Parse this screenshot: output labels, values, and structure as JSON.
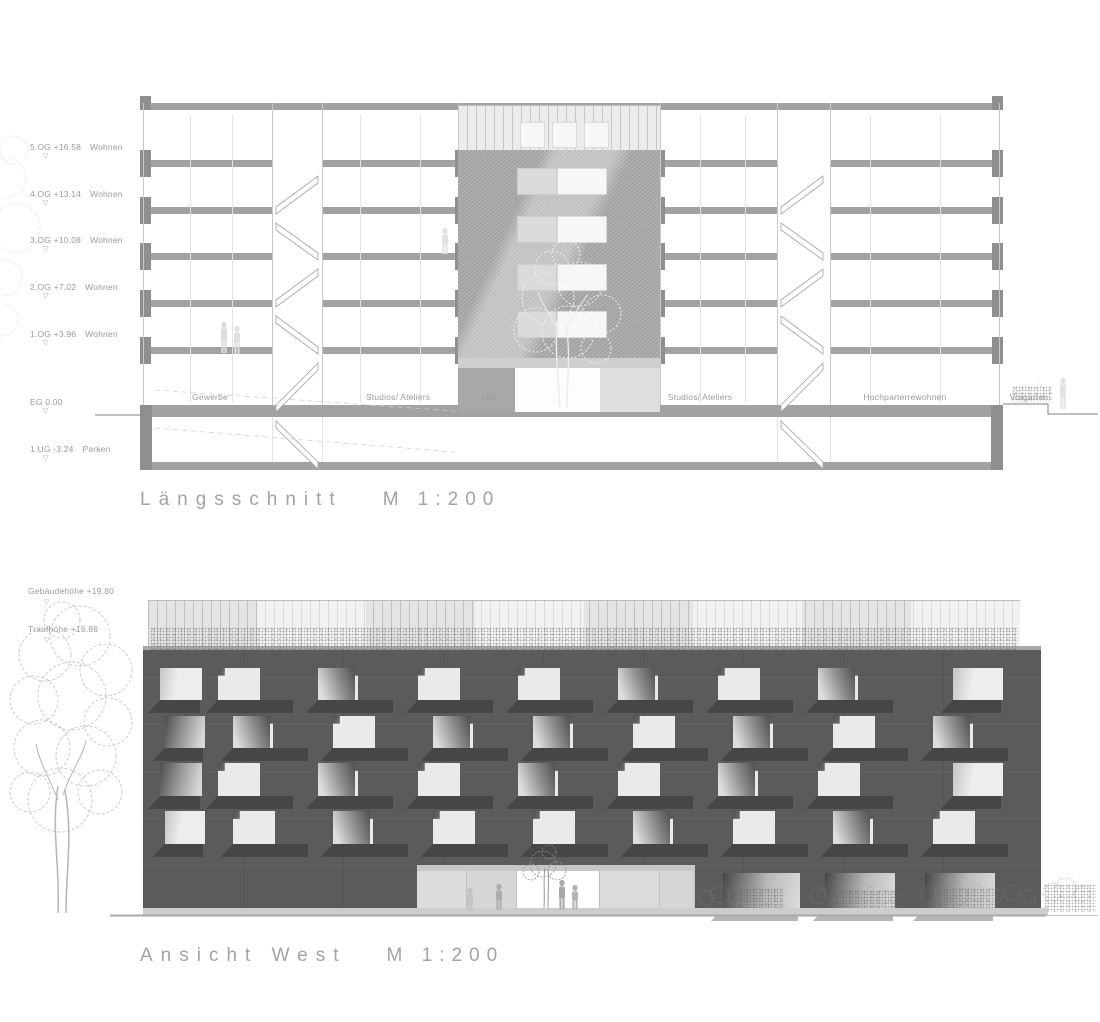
{
  "section": {
    "title": {
      "name": "Längsschnitt",
      "scale": "M 1:200"
    },
    "levels": [
      {
        "label": "5.OG +16.58",
        "use": "Wohnen",
        "y": 160
      },
      {
        "label": "4.OG +13.14",
        "use": "Wohnen",
        "y": 207
      },
      {
        "label": "3.OG +10.08",
        "use": "Wohnen",
        "y": 253
      },
      {
        "label": "2.OG +7.02",
        "use": "Wohnen",
        "y": 300
      },
      {
        "label": "1.OG +3.96",
        "use": "Wohnen",
        "y": 347
      },
      {
        "label": "EG 0.00",
        "use": "",
        "y": 415
      },
      {
        "label": "1.UG -3.24",
        "use": "Parken",
        "y": 462
      }
    ],
    "rooms": [
      {
        "label": "Gewerbe",
        "x": 210
      },
      {
        "label": "Studios/ Ateliers",
        "x": 398
      },
      {
        "label": "Hof",
        "x": 489
      },
      {
        "label": "Studios/ Ateliers",
        "x": 700
      },
      {
        "label": "Hochparterrewohnen",
        "x": 905
      },
      {
        "label": "Vorgarten",
        "x": 1029
      }
    ]
  },
  "elevation": {
    "title": {
      "name": "Ansicht West",
      "scale": "M 1:200"
    },
    "marks": [
      {
        "label": "Gebäudehöhe +19.80",
        "y": 586
      },
      {
        "label": "Traufhöhe +16.86",
        "y": 624
      }
    ],
    "facade": {
      "rows": [
        {
          "y": 18,
          "h": 32,
          "items": [
            {
              "x": 17,
              "w": 42,
              "t": "flat"
            },
            {
              "x": 75,
              "w": 77,
              "t": "ba"
            },
            {
              "x": 175,
              "w": 77,
              "t": "bb"
            },
            {
              "x": 275,
              "w": 77,
              "t": "ba"
            },
            {
              "x": 375,
              "w": 77,
              "t": "ba"
            },
            {
              "x": 475,
              "w": 77,
              "t": "bb"
            },
            {
              "x": 575,
              "w": 77,
              "t": "ba"
            },
            {
              "x": 675,
              "w": 77,
              "t": "bb"
            },
            {
              "x": 810,
              "w": 50,
              "t": "flat"
            }
          ]
        },
        {
          "y": 66,
          "h": 32,
          "items": [
            {
              "x": 22,
              "w": 40,
              "t": "grad"
            },
            {
              "x": 90,
              "w": 77,
              "t": "bb"
            },
            {
              "x": 190,
              "w": 77,
              "t": "ba"
            },
            {
              "x": 290,
              "w": 77,
              "t": "bb"
            },
            {
              "x": 390,
              "w": 77,
              "t": "bb"
            },
            {
              "x": 490,
              "w": 77,
              "t": "ba"
            },
            {
              "x": 590,
              "w": 77,
              "t": "bb"
            },
            {
              "x": 690,
              "w": 77,
              "t": "ba"
            },
            {
              "x": 790,
              "w": 77,
              "t": "bb"
            }
          ]
        },
        {
          "y": 113,
          "h": 33,
          "items": [
            {
              "x": 17,
              "w": 42,
              "t": "grad"
            },
            {
              "x": 75,
              "w": 77,
              "t": "ba"
            },
            {
              "x": 175,
              "w": 77,
              "t": "bb"
            },
            {
              "x": 275,
              "w": 77,
              "t": "ba"
            },
            {
              "x": 375,
              "w": 77,
              "t": "bb"
            },
            {
              "x": 475,
              "w": 77,
              "t": "ba"
            },
            {
              "x": 575,
              "w": 77,
              "t": "bb"
            },
            {
              "x": 675,
              "w": 77,
              "t": "ba"
            },
            {
              "x": 810,
              "w": 50,
              "t": "flat"
            }
          ]
        },
        {
          "y": 161,
          "h": 33,
          "items": [
            {
              "x": 22,
              "w": 40,
              "t": "flat"
            },
            {
              "x": 90,
              "w": 77,
              "t": "ba"
            },
            {
              "x": 190,
              "w": 77,
              "t": "bb"
            },
            {
              "x": 290,
              "w": 77,
              "t": "ba"
            },
            {
              "x": 390,
              "w": 77,
              "t": "ba"
            },
            {
              "x": 490,
              "w": 77,
              "t": "bb"
            },
            {
              "x": 590,
              "w": 77,
              "t": "ba"
            },
            {
              "x": 690,
              "w": 77,
              "t": "bb"
            },
            {
              "x": 790,
              "w": 77,
              "t": "ba"
            }
          ]
        }
      ],
      "eg_openings": [
        {
          "x": 580,
          "w": 77
        },
        {
          "x": 682,
          "w": 70
        },
        {
          "x": 782,
          "w": 70
        }
      ]
    }
  },
  "colors": {
    "facade_gray": "#5b5b5b",
    "drawing_gray": "#9c9c9c",
    "opening_light": "#e9e9e9",
    "text_gray": "#9b9b9b"
  }
}
